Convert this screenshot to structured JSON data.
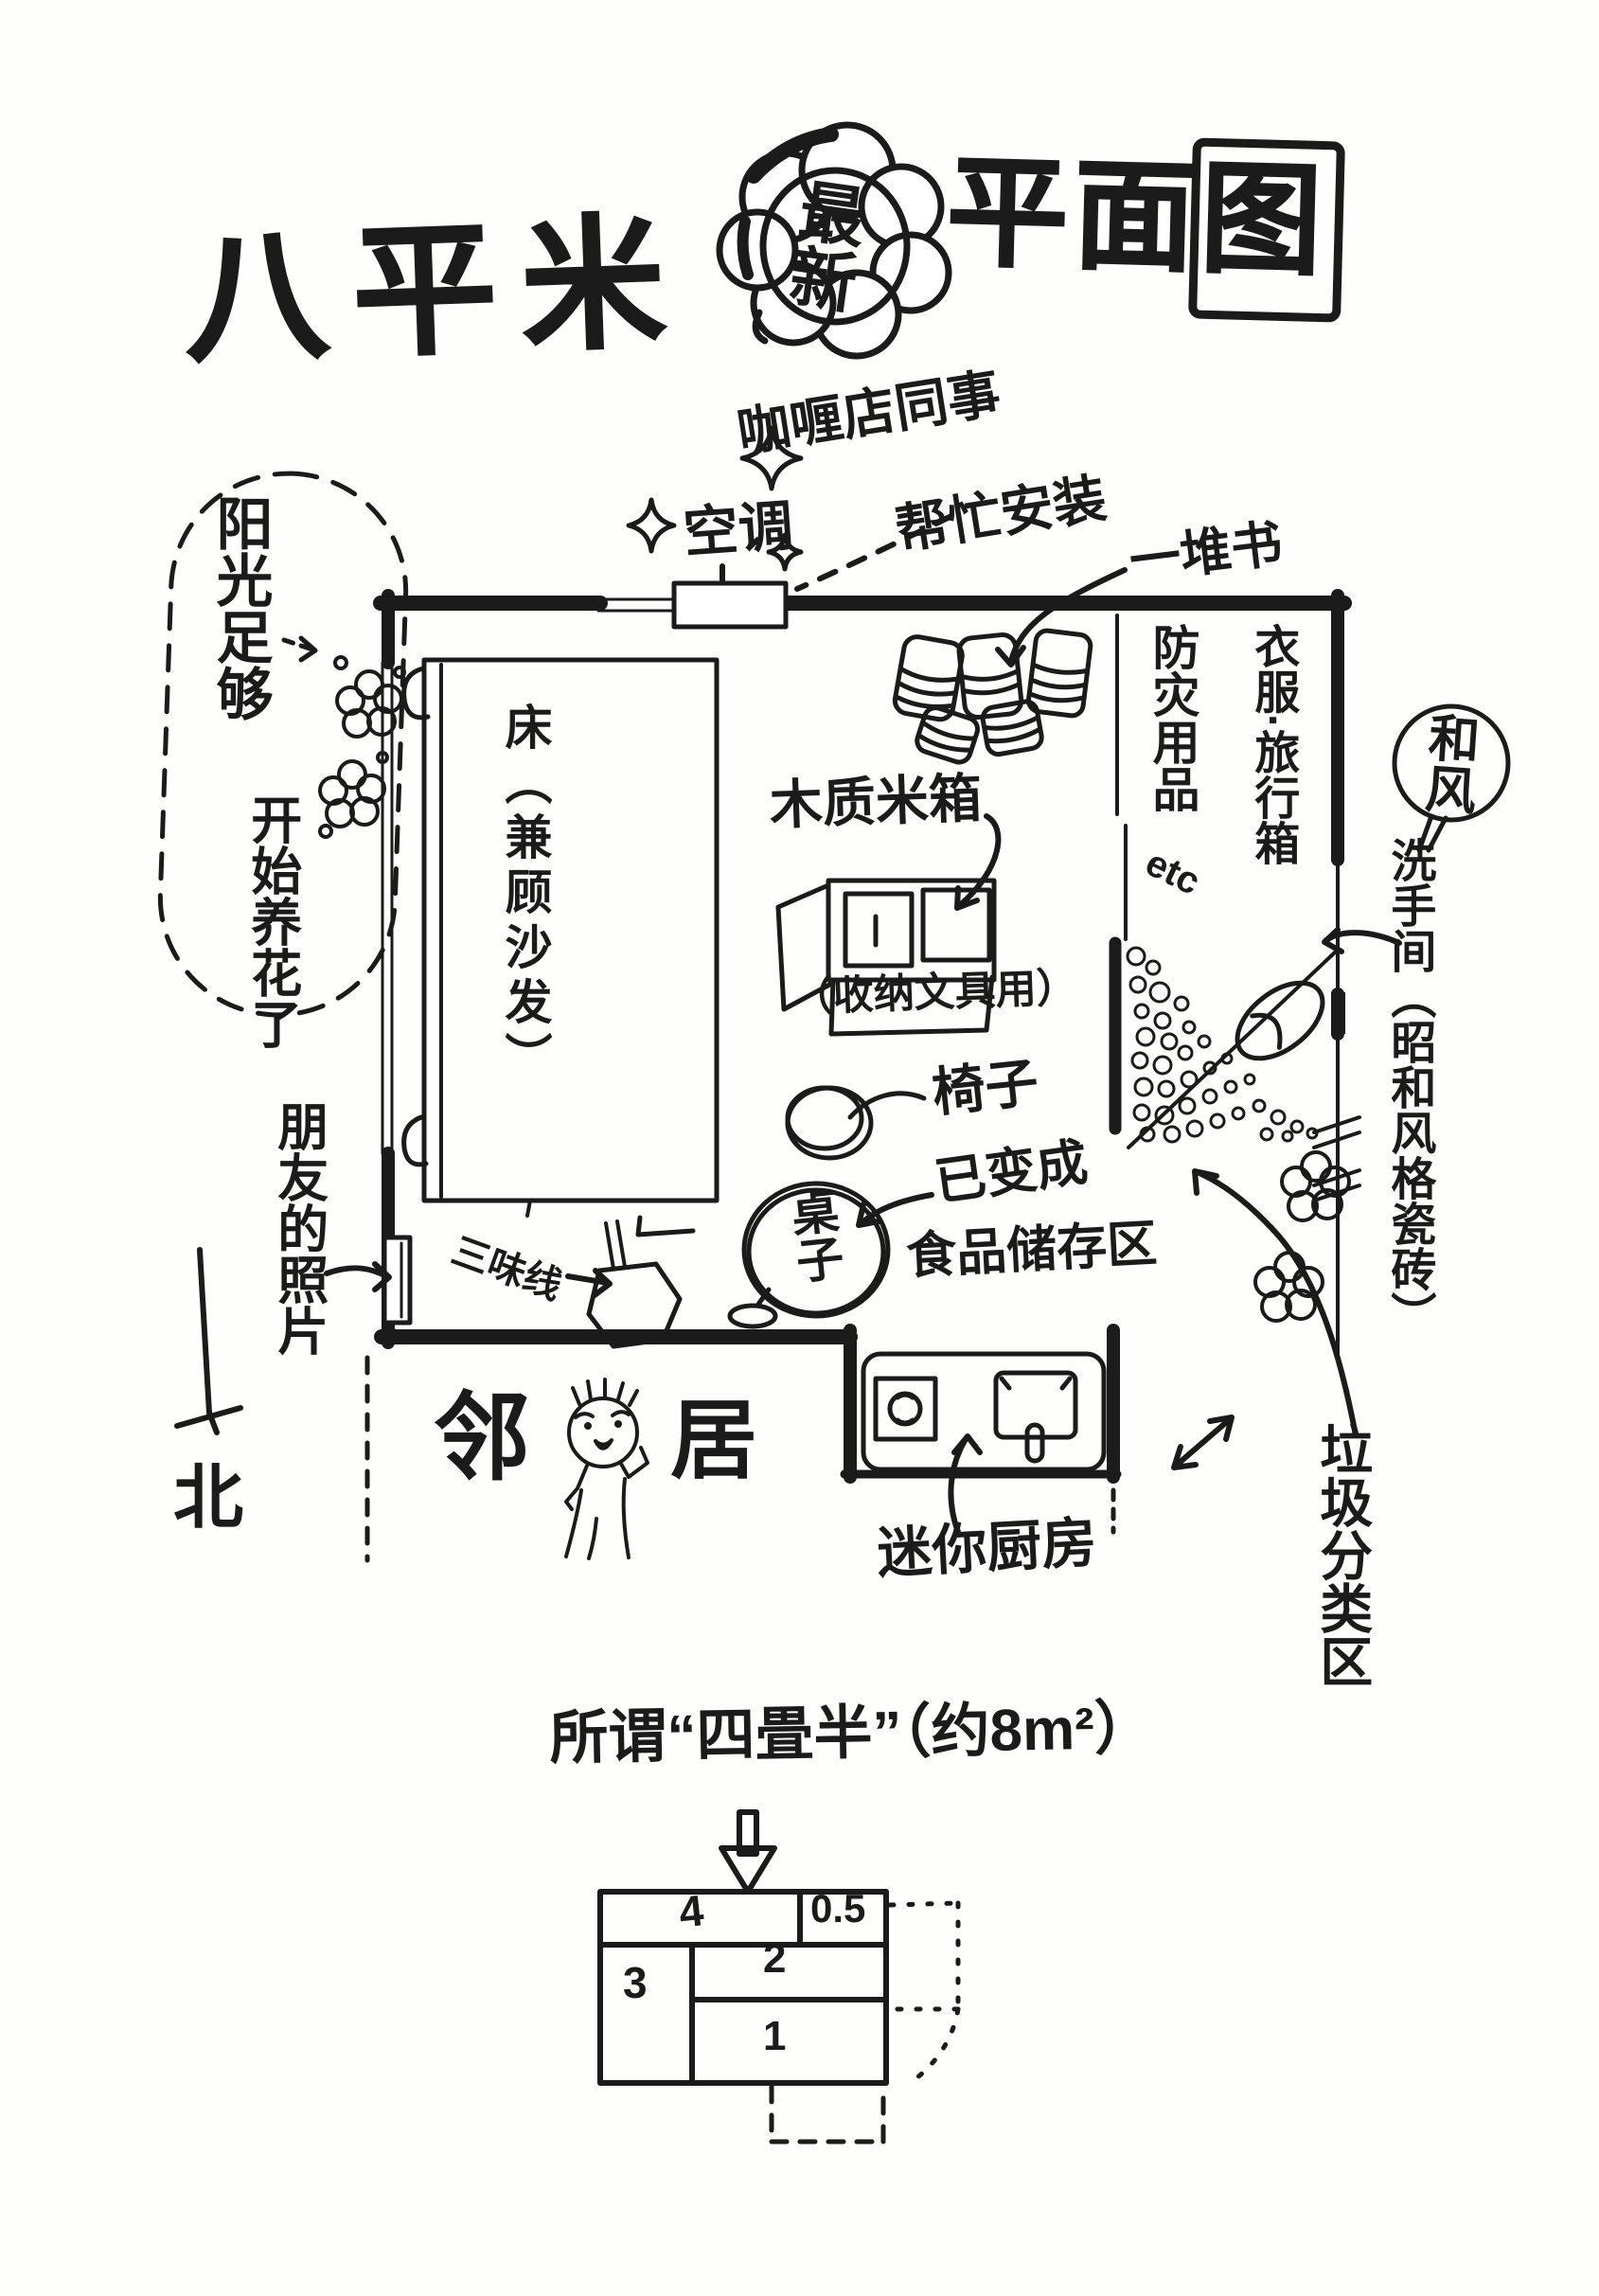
{
  "title": {
    "main": "八平米",
    "cloud": "最新",
    "suffix": "平面图"
  },
  "annotations": {
    "ac_installer_line1": "咖喱店同事",
    "ac_installer_line2": "帮忙安装",
    "air_conditioner": "空调",
    "book_pile": "一堆书",
    "sunlight_bubble_line1": "阳光足够",
    "sunlight_bubble_line2": "开始养花了",
    "friends_photos": "朋友的照片",
    "north": "北",
    "neighbor_left": "邻",
    "neighbor_right": "居",
    "mini_kitchen": "迷你厨房",
    "garbage_area": "垃圾分类区",
    "washroom_style": "和风",
    "washroom": "洗手间（昭和风格瓷砖）",
    "closet_left": "防灾用品",
    "closet_left_etc": "etc",
    "closet_right": "衣服·旅行箱"
  },
  "room": {
    "bed": "床（兼顾沙发）",
    "rice_box": "木质米箱",
    "rice_box_note": "（收纳文具用）",
    "chair": "椅子",
    "table": "桌子",
    "table_note_line1": "已变成",
    "table_note_line2": "食品储存区",
    "shamisen": "三味线"
  },
  "footer": {
    "heading": "所谓“四畳半”（约8m²）",
    "tatami_values": [
      "4",
      "0.5",
      "3",
      "2",
      "1"
    ]
  }
}
